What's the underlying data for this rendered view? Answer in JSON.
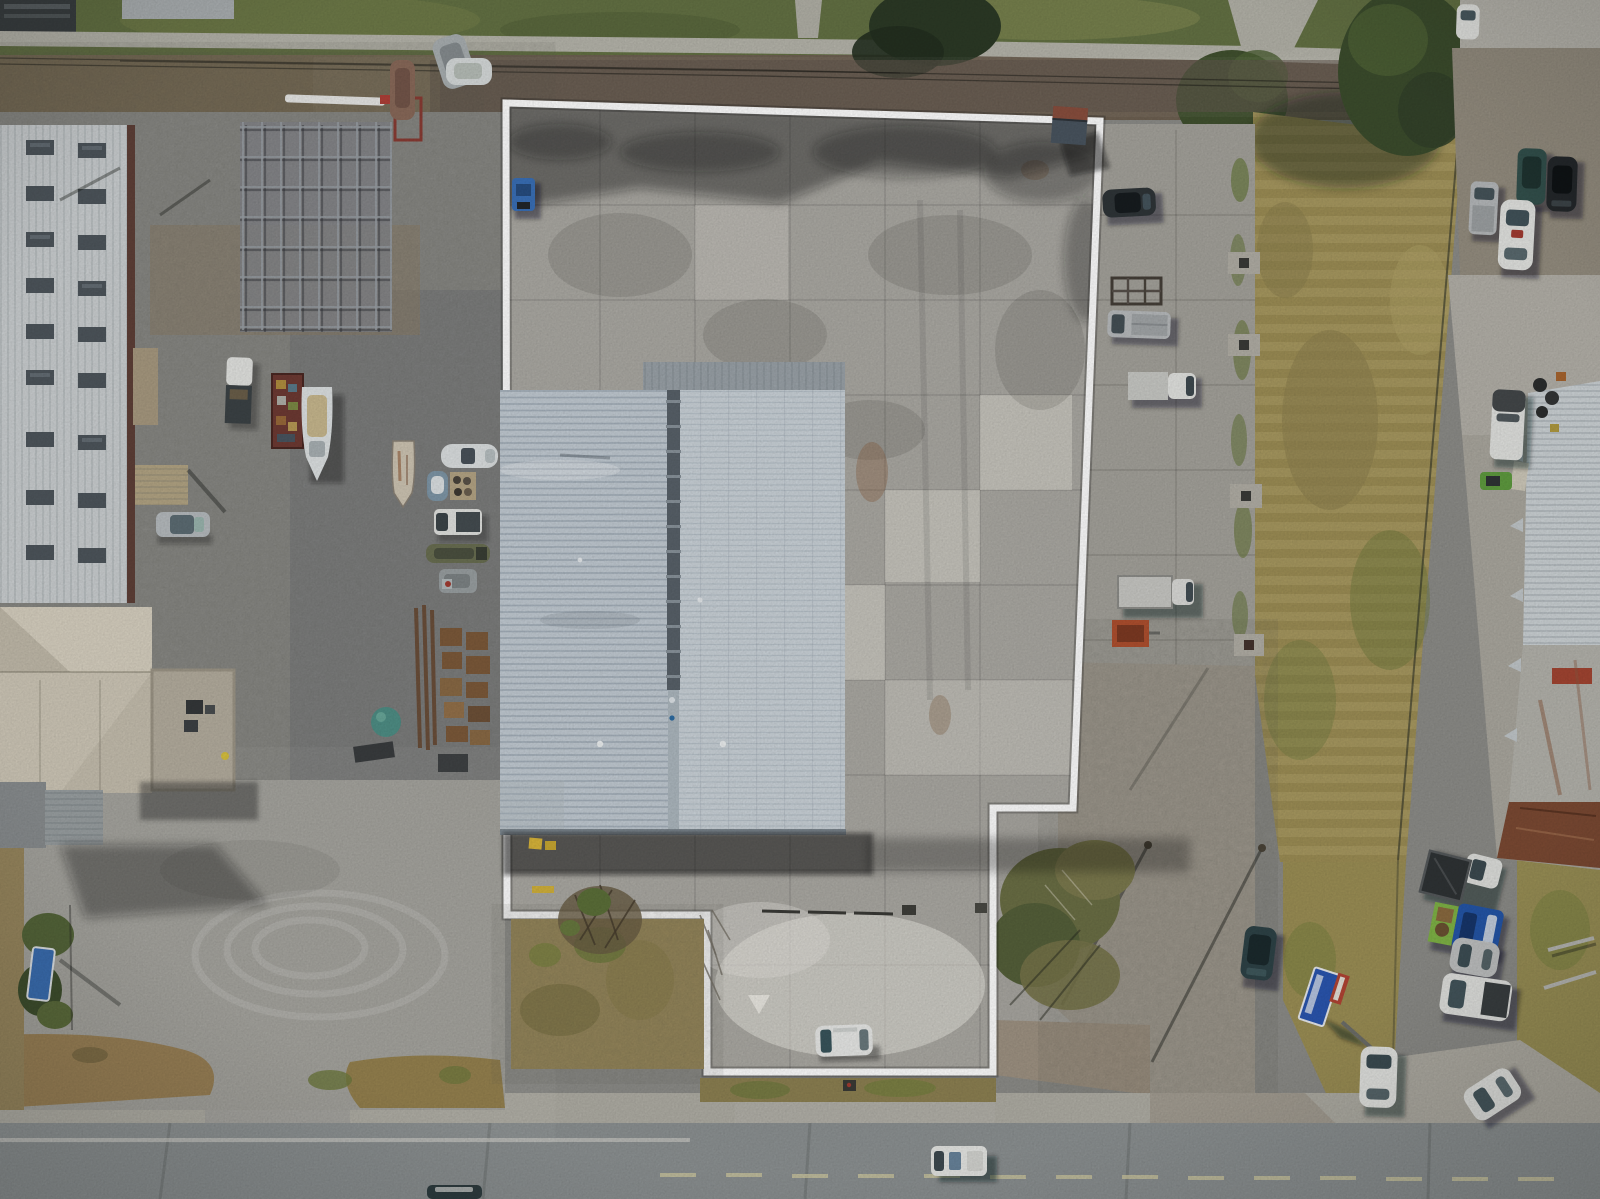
{
  "meta": {
    "title": "Aerial drone photograph of outlined commercial parcel",
    "viewBox": "0 0 1600 1199",
    "width": 1600,
    "height": 1199,
    "description": "Top-down aerial photo: industrial parcel outlined in white containing a large white metal-roof warehouse and concrete pad; boat yard and metal buildings on the left; dry grass field, parked vehicles and a rusty-roof warehouse on the right; two-lane road across the bottom."
  },
  "annotation": {
    "boundary_color": "#ffffff",
    "boundary_points": "506,103 1100,121 1073,808 993,808 993,1072 707,1072 707,915 507,915",
    "stroke_width": 7
  },
  "palette": {
    "grass_top": "#647244",
    "scrub_band": "#6e6152",
    "field_grass": "#a39358",
    "boatyard_gravel": "#8d8d89",
    "lot_gravel": "#a3a29c",
    "concrete_pad": "#a8a6a0",
    "roof_left_half": "#c3ccd4",
    "roof_right_half": "#ccd4da",
    "roof_ridge": "#59626a",
    "road_asphalt": "#8d9293",
    "dirt_strip": "#9b8257",
    "shadow": "#14181a",
    "sign_blue": "#2a56b0",
    "truck_blue": "#2456a8",
    "pallet_yellow": "#d9b53a"
  },
  "scene": {
    "parcel": {
      "surfaces": [
        "concrete pad",
        "warehouse roof",
        "loading apron",
        "driveway tab to road"
      ],
      "objects": [
        "small shed at NE corner",
        "blue forklift at NW corner",
        "white parked car on south tab",
        "yellow pallets at dock",
        "white triangle pavement mark"
      ]
    },
    "warehouse": {
      "roof_halves": 2,
      "ridge": "dark seam with snow guards",
      "clerestory_strip": "gray upper section"
    },
    "left_yard": {
      "buildings": [
        "white ribbed warehouse with skylights",
        "cream hip-roof shop",
        "flat-roof annex with AC units",
        "awning shed"
      ],
      "objects": [
        "open steel frame structure",
        "white boats",
        "faded boat",
        "center-console boat",
        "jon boat",
        "junk trailer",
        "white pickups",
        "silver car",
        "teal dome tank",
        "rusty steel and pallet stacks",
        "blue roadside sign garden"
      ]
    },
    "east_strip": {
      "objects": [
        "dark sedan",
        "burned trailer frame",
        "silver pickup",
        "white box van",
        "box truck",
        "orange mini trailer",
        "utility pads",
        "brush cluster",
        "fallen blue billboard sign",
        "dark SUV",
        "white hatchback",
        "angled white sedan"
      ]
    },
    "right_side": {
      "objects": [
        "green tree",
        "utility pole",
        "teal SUV",
        "black sedan",
        "silver pickup",
        "white sedan",
        "white van",
        "green mower",
        "dumpster pickup",
        "blue flatbed truck",
        "silver car",
        "white SUV",
        "metal poles in grass",
        "rusty-roof warehouse with red patch"
      ]
    },
    "road": {
      "vehicles": [
        "white van eastbound",
        "dark teal car at bottom edge"
      ],
      "markings": [
        "white fog line",
        "pale yellow center line"
      ]
    }
  }
}
